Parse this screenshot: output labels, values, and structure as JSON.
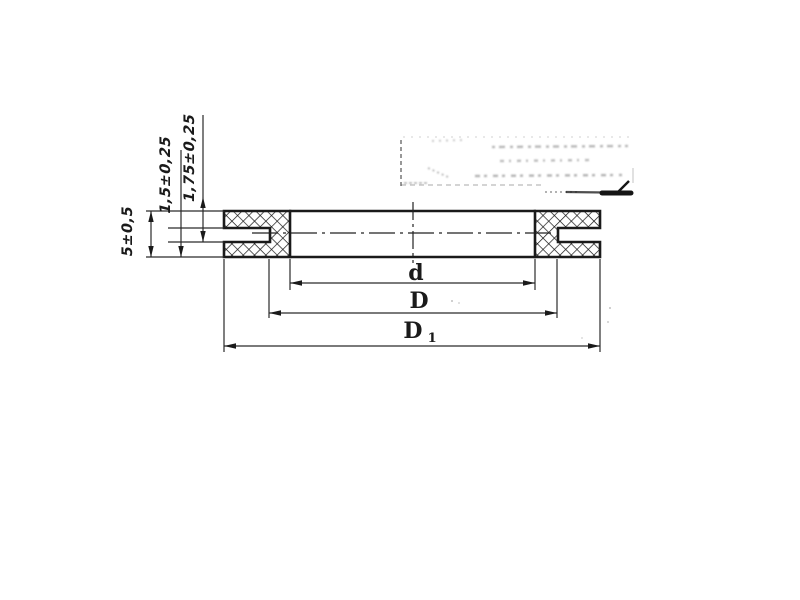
{
  "colors": {
    "ink": "#1a1a1a",
    "thin_ink": "#2a2a2a",
    "paper": "#ffffff"
  },
  "dimension_labels": {
    "overall_thickness": "5±0,5",
    "groove_width": "1,5±0,25",
    "flange_thickness": "1,75±0,25",
    "inner_diameter": "d",
    "groove_diameter": "D",
    "outer_diameter_base": "D",
    "outer_diameter_sub": "1"
  }
}
